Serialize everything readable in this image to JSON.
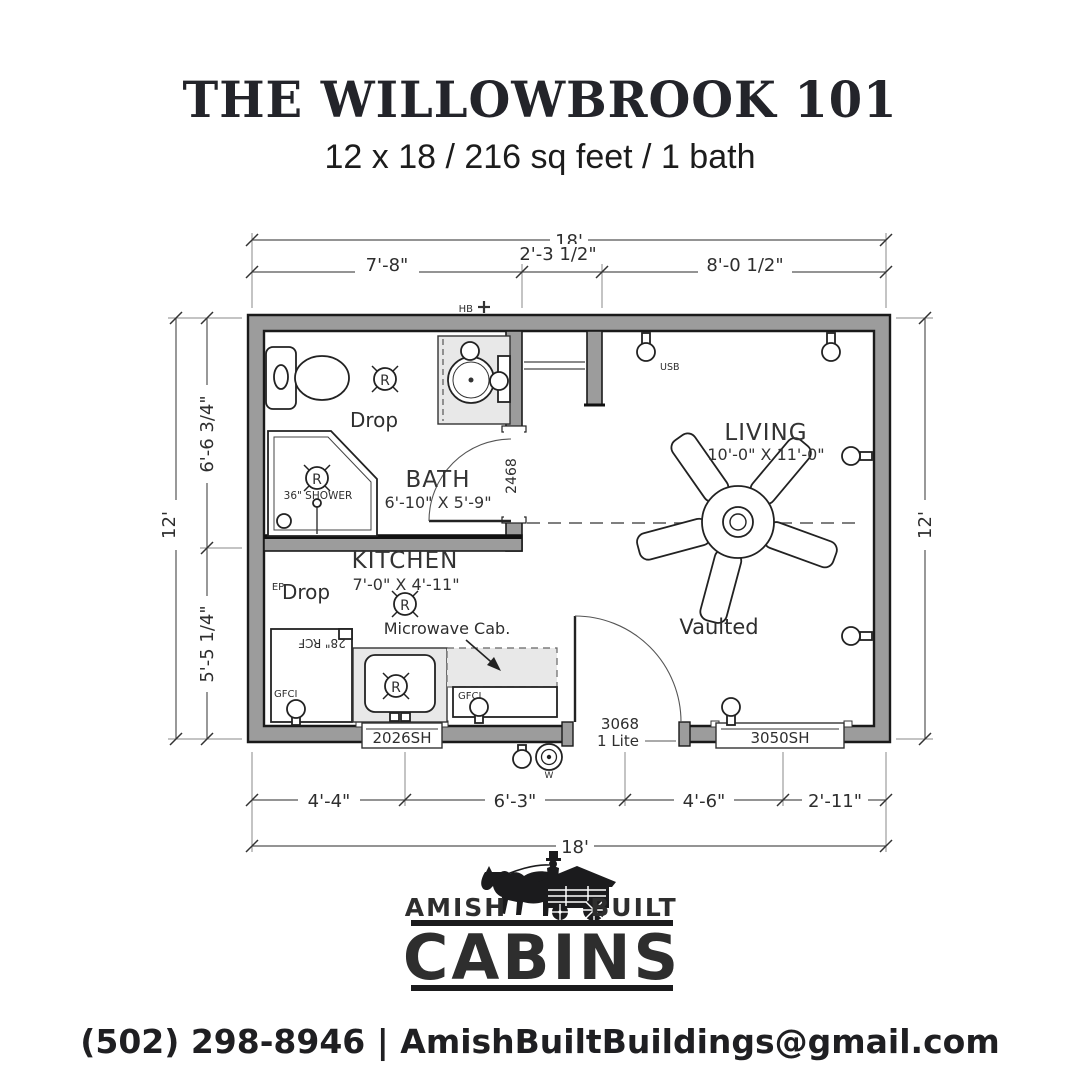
{
  "header": {
    "title": "THE WILLOWBROOK 101",
    "subtitle": "12 x 18 / 216 sq feet / 1 bath"
  },
  "plan": {
    "dim_top": {
      "overall": "18'",
      "segments": [
        "7'-8\"",
        "2'-3 1/2\"",
        "8'-0 1/2\""
      ]
    },
    "dim_bottom": {
      "overall": "18'",
      "segments": [
        "4'-4\"",
        "6'-3\"",
        "4'-6\"",
        "2'-11\""
      ]
    },
    "dim_left": {
      "overall": "12'",
      "segments": [
        "6'-6 3/4\"",
        "5'-5 1/4\""
      ]
    },
    "dim_right": {
      "overall": "12'"
    },
    "rooms": {
      "bath": {
        "name": "BATH",
        "size": "6'-10\" X 5'-9\""
      },
      "kitchen": {
        "name": "KITCHEN",
        "size": "7'-0\" X 4'-11\""
      },
      "living": {
        "name": "LIVING",
        "size": "10'-0\" X 11'-0\"",
        "ceiling": "Vaulted"
      }
    },
    "labels": {
      "drop": "Drop",
      "shower": "36\" SHOWER",
      "microwave": "Microwave Cab.",
      "fridge": "28\" RCF",
      "ep": "EP",
      "hb": "HB",
      "usb": "USB",
      "gfci": "GFCI",
      "w": "W",
      "r": "R"
    },
    "openings": {
      "kitchen_window": "2026SH",
      "living_window": "3050SH",
      "entry_door": "3068",
      "entry_door_type": "1 Lite",
      "bath_door": "2468"
    }
  },
  "footer": {
    "brand": {
      "left": "AMISH",
      "right": "BUILT",
      "main": "CABINS"
    },
    "contact": "(502) 298-8946 | AmishBuiltBuildings@gmail.com"
  },
  "colors": {
    "wall": "#9c9c9c",
    "ink": "#1b1b1d",
    "fixture": "#e8e8e8"
  }
}
